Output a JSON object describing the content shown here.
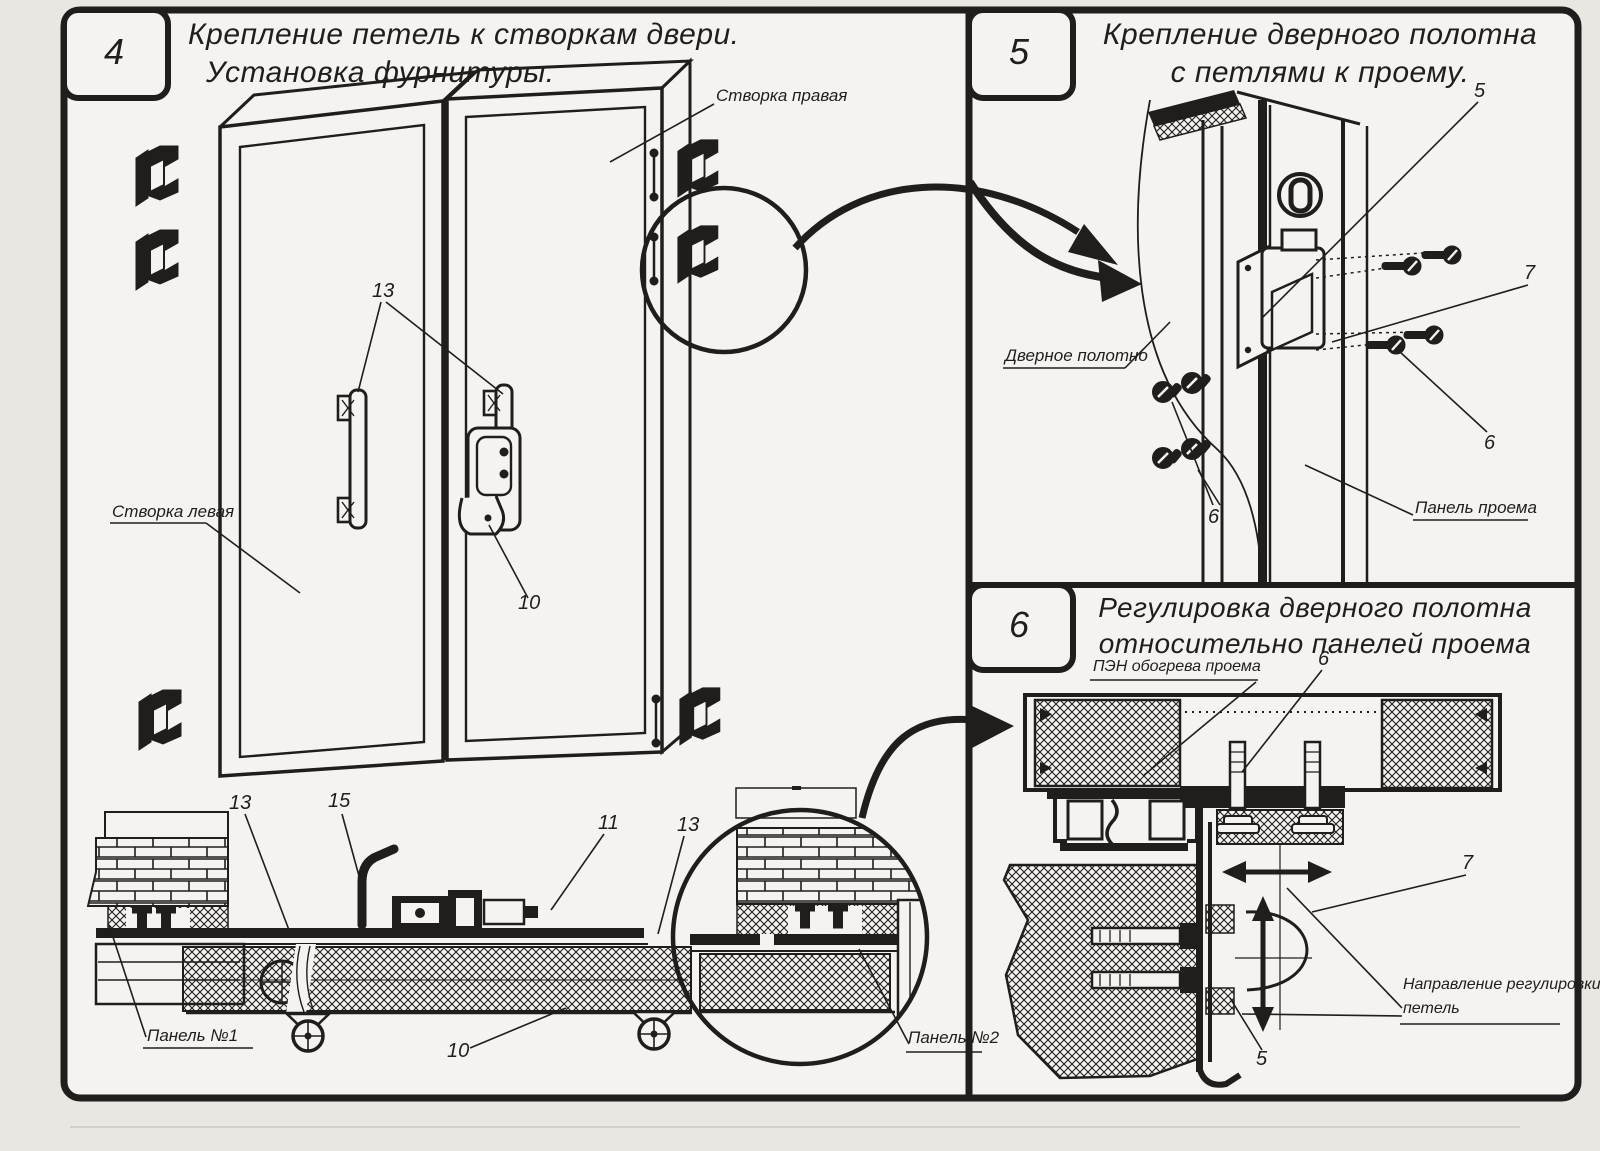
{
  "doc": {
    "kind": "assembly-instruction-sheet",
    "ink_color": "#1f1e1c",
    "paper_color": "#f4f3ef"
  },
  "panel4": {
    "number": "4",
    "title1": "Крепление петель к створкам двери.",
    "title2": "Установка фурнитуры.",
    "labels": {
      "right_leaf": "Створка правая",
      "left_leaf": "Створка левая",
      "panel1": "Панель №1",
      "panel2": "Панель №2"
    },
    "callouts": {
      "c13a": "13",
      "c10a": "10",
      "c13b": "13",
      "c15": "15",
      "c11": "11",
      "c13c": "13",
      "c10b": "10"
    }
  },
  "panel5": {
    "number": "5",
    "title1": "Крепление дверного полотна",
    "title2": "с петлями к проему.",
    "labels": {
      "door_leaf": "Дверное полотно",
      "opening_panel": "Панель проема"
    },
    "callouts": {
      "c5": "5",
      "c7": "7",
      "c6a": "6",
      "c6b": "6"
    }
  },
  "panel6": {
    "number": "6",
    "title1": "Регулировка дверного полотна",
    "title2": "относительно панелей проема",
    "labels": {
      "pen": "ПЭН обогрева проема",
      "direction1": "Направление регулировки",
      "direction2": "петель"
    },
    "callouts": {
      "c6": "6",
      "c7": "7",
      "c5": "5"
    }
  }
}
